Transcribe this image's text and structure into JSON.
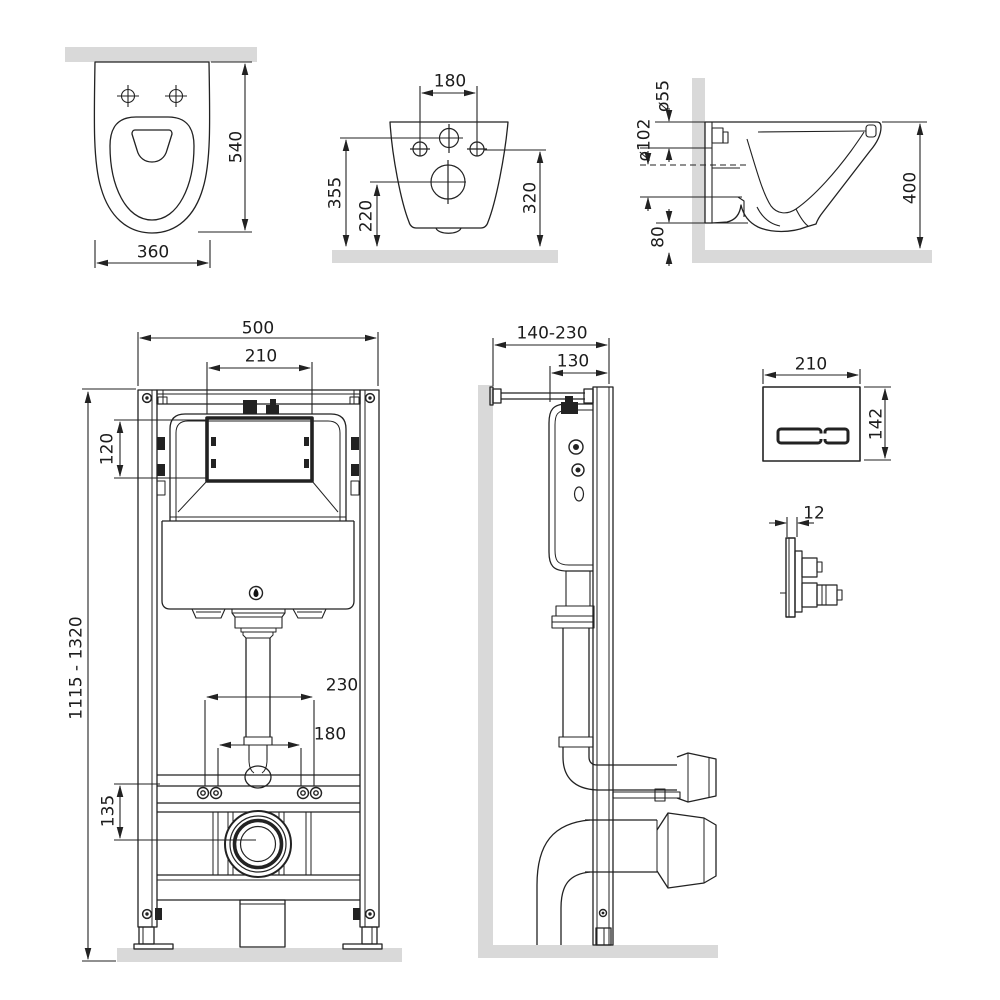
{
  "drawing_title": "Wall-hung WC and installation frame dimensional drawing",
  "views": {
    "toilet_top": {
      "label": "toilet top view",
      "depth": "540",
      "width": "360"
    },
    "toilet_rear": {
      "label": "toilet rear view",
      "hole_spacing": "180",
      "height_top": "355",
      "height_outlet": "220",
      "height_side": "320"
    },
    "toilet_side": {
      "label": "toilet side view",
      "inlet_diameter": "ø55",
      "outlet_diameter": "ø102",
      "height": "400",
      "bottom_gap": "80"
    },
    "frame_front": {
      "label": "installation frame front view",
      "frame_width": "500",
      "window_width": "210",
      "window_height": "120",
      "height_range": "1115 - 1320",
      "spacing_outer": "230",
      "spacing_inner": "180",
      "drain_offset": "135"
    },
    "frame_side": {
      "label": "installation frame side view",
      "depth_range": "140-230",
      "frame_depth": "130"
    },
    "flush_plate_front": {
      "label": "flush plate front view",
      "width": "210",
      "height": "142"
    },
    "flush_plate_side": {
      "label": "flush plate side view",
      "thickness": "12"
    }
  },
  "colors": {
    "line": "#222222",
    "wall_fill": "#d9d9d9",
    "background": "#ffffff"
  }
}
